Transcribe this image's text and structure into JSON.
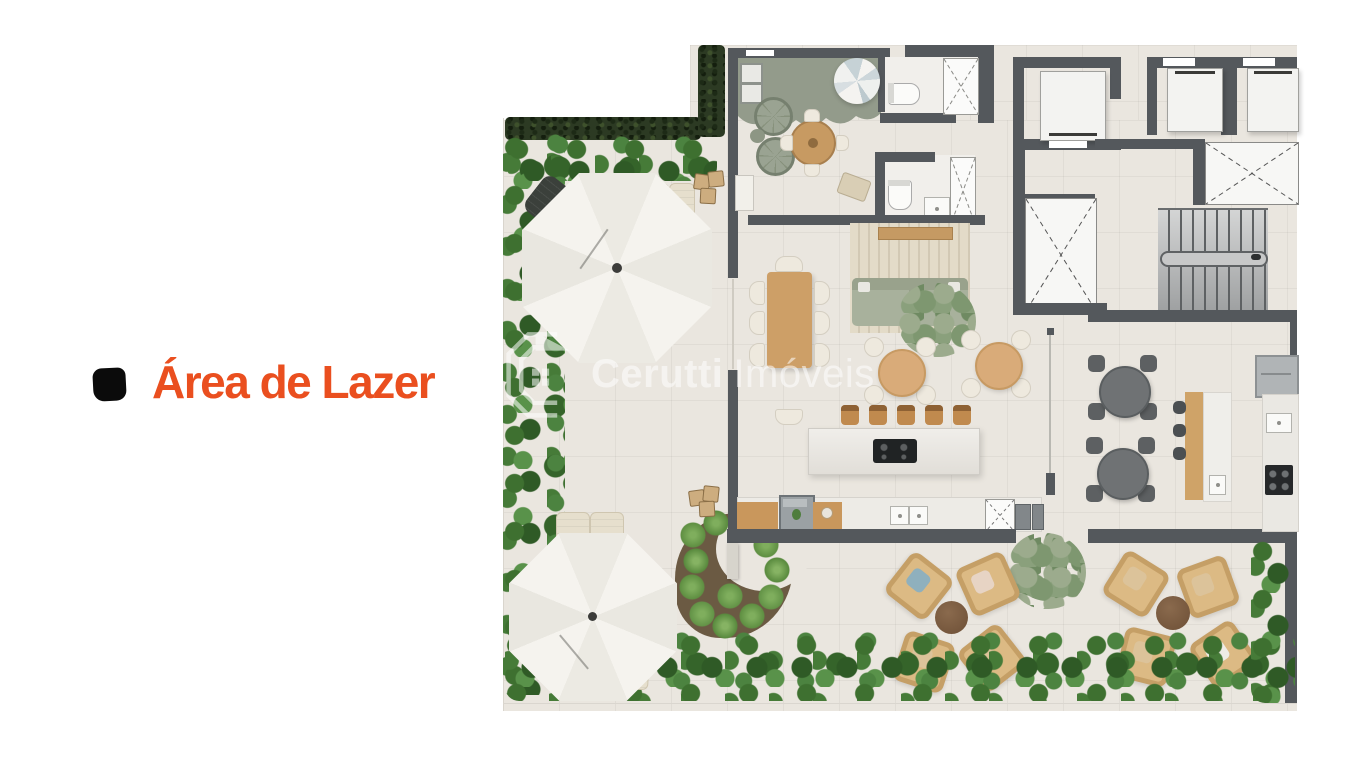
{
  "label": {
    "text": "Área de Lazer",
    "text_color": "#ea4f1f",
    "bullet_color": "#0b0b0b"
  },
  "watermark": {
    "brand_bold": "Cerutti",
    "brand_light": "Imóveis",
    "logo": "cerutti-house-logo",
    "color": "#ffffff",
    "opacity": 0.55
  },
  "plan": {
    "description_colors": {
      "floor": "#eae6df",
      "wall": "#54585c",
      "hedge_dark": "#2c3a23",
      "foliage": "#3f7033",
      "playroom_floor": "#939b8b",
      "wood": "#cd9f67",
      "wicker": "#dcba84",
      "sofa": "#a8b19c",
      "gourmet_table": "#6f7274",
      "umbrella": "#f3f1ec"
    }
  }
}
